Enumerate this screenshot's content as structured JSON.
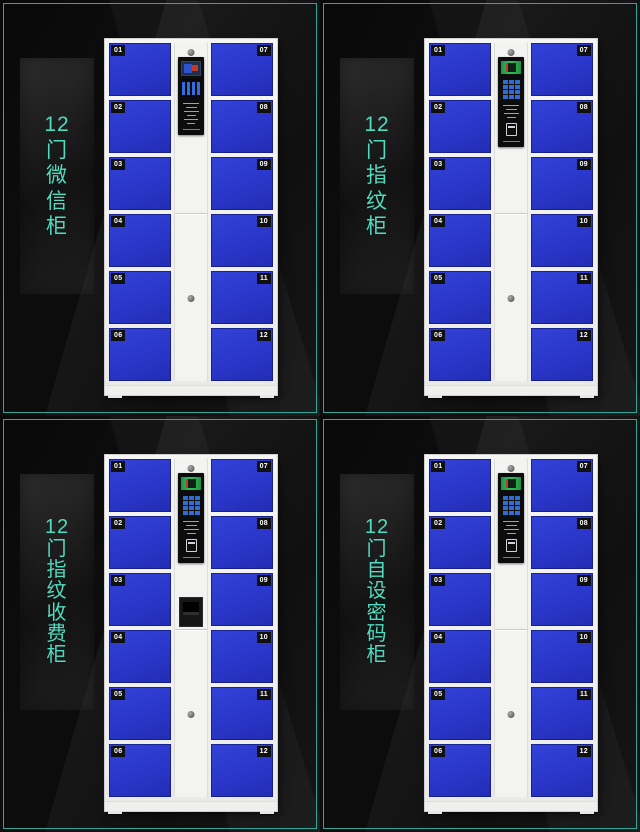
{
  "page": {
    "background_color": "#000000",
    "accent_border_color": "#2ea79b",
    "label_text_color": "#4fdcc0",
    "door_color": "#2a36c9",
    "cabinet_color": "#f2f2f0",
    "control_panel_color": "#0c0c0c",
    "scanner_green": "#2ec160",
    "keypad_blue": "#2e6cd6"
  },
  "quadrants": [
    {
      "id": "wechat",
      "label": "12门微信柜",
      "label_lines": [
        "12",
        "门",
        "微",
        "信",
        "柜"
      ],
      "panel": {
        "type": "wechat",
        "features": [
          "lcd-screen",
          "qr-code-display",
          "instruction-text"
        ]
      },
      "doors_left": [
        "01",
        "02",
        "03",
        "04",
        "05",
        "06"
      ],
      "doors_right": [
        "07",
        "08",
        "09",
        "10",
        "11",
        "12"
      ]
    },
    {
      "id": "fingerprint",
      "label": "12门指纹柜",
      "label_lines": [
        "12",
        "门",
        "指",
        "纹",
        "柜"
      ],
      "panel": {
        "type": "fingerprint",
        "features": [
          "fingerprint-scanner",
          "number-keypad",
          "instruction-text",
          "card-slot"
        ]
      },
      "doors_left": [
        "01",
        "02",
        "03",
        "04",
        "05",
        "06"
      ],
      "doors_right": [
        "07",
        "08",
        "09",
        "10",
        "11",
        "12"
      ]
    },
    {
      "id": "fingerprint-pay",
      "label": "12门指纹收费柜",
      "label_lines": [
        "12",
        "门",
        "指",
        "纹",
        "收",
        "费",
        "柜"
      ],
      "panel": {
        "type": "fingerprint",
        "coin_acceptor": true,
        "features": [
          "fingerprint-scanner",
          "number-keypad",
          "instruction-text",
          "card-slot",
          "coin-acceptor"
        ]
      },
      "doors_left": [
        "01",
        "02",
        "03",
        "04",
        "05",
        "06"
      ],
      "doors_right": [
        "07",
        "08",
        "09",
        "10",
        "11",
        "12"
      ]
    },
    {
      "id": "password",
      "label": "12门自设密码柜",
      "label_lines": [
        "12",
        "门",
        "自",
        "设",
        "密",
        "码",
        "柜"
      ],
      "panel": {
        "type": "password",
        "features": [
          "scanner-window",
          "number-keypad",
          "instruction-text",
          "card-slot"
        ]
      },
      "doors_left": [
        "01",
        "02",
        "03",
        "04",
        "05",
        "06"
      ],
      "doors_right": [
        "07",
        "08",
        "09",
        "10",
        "11",
        "12"
      ]
    }
  ]
}
